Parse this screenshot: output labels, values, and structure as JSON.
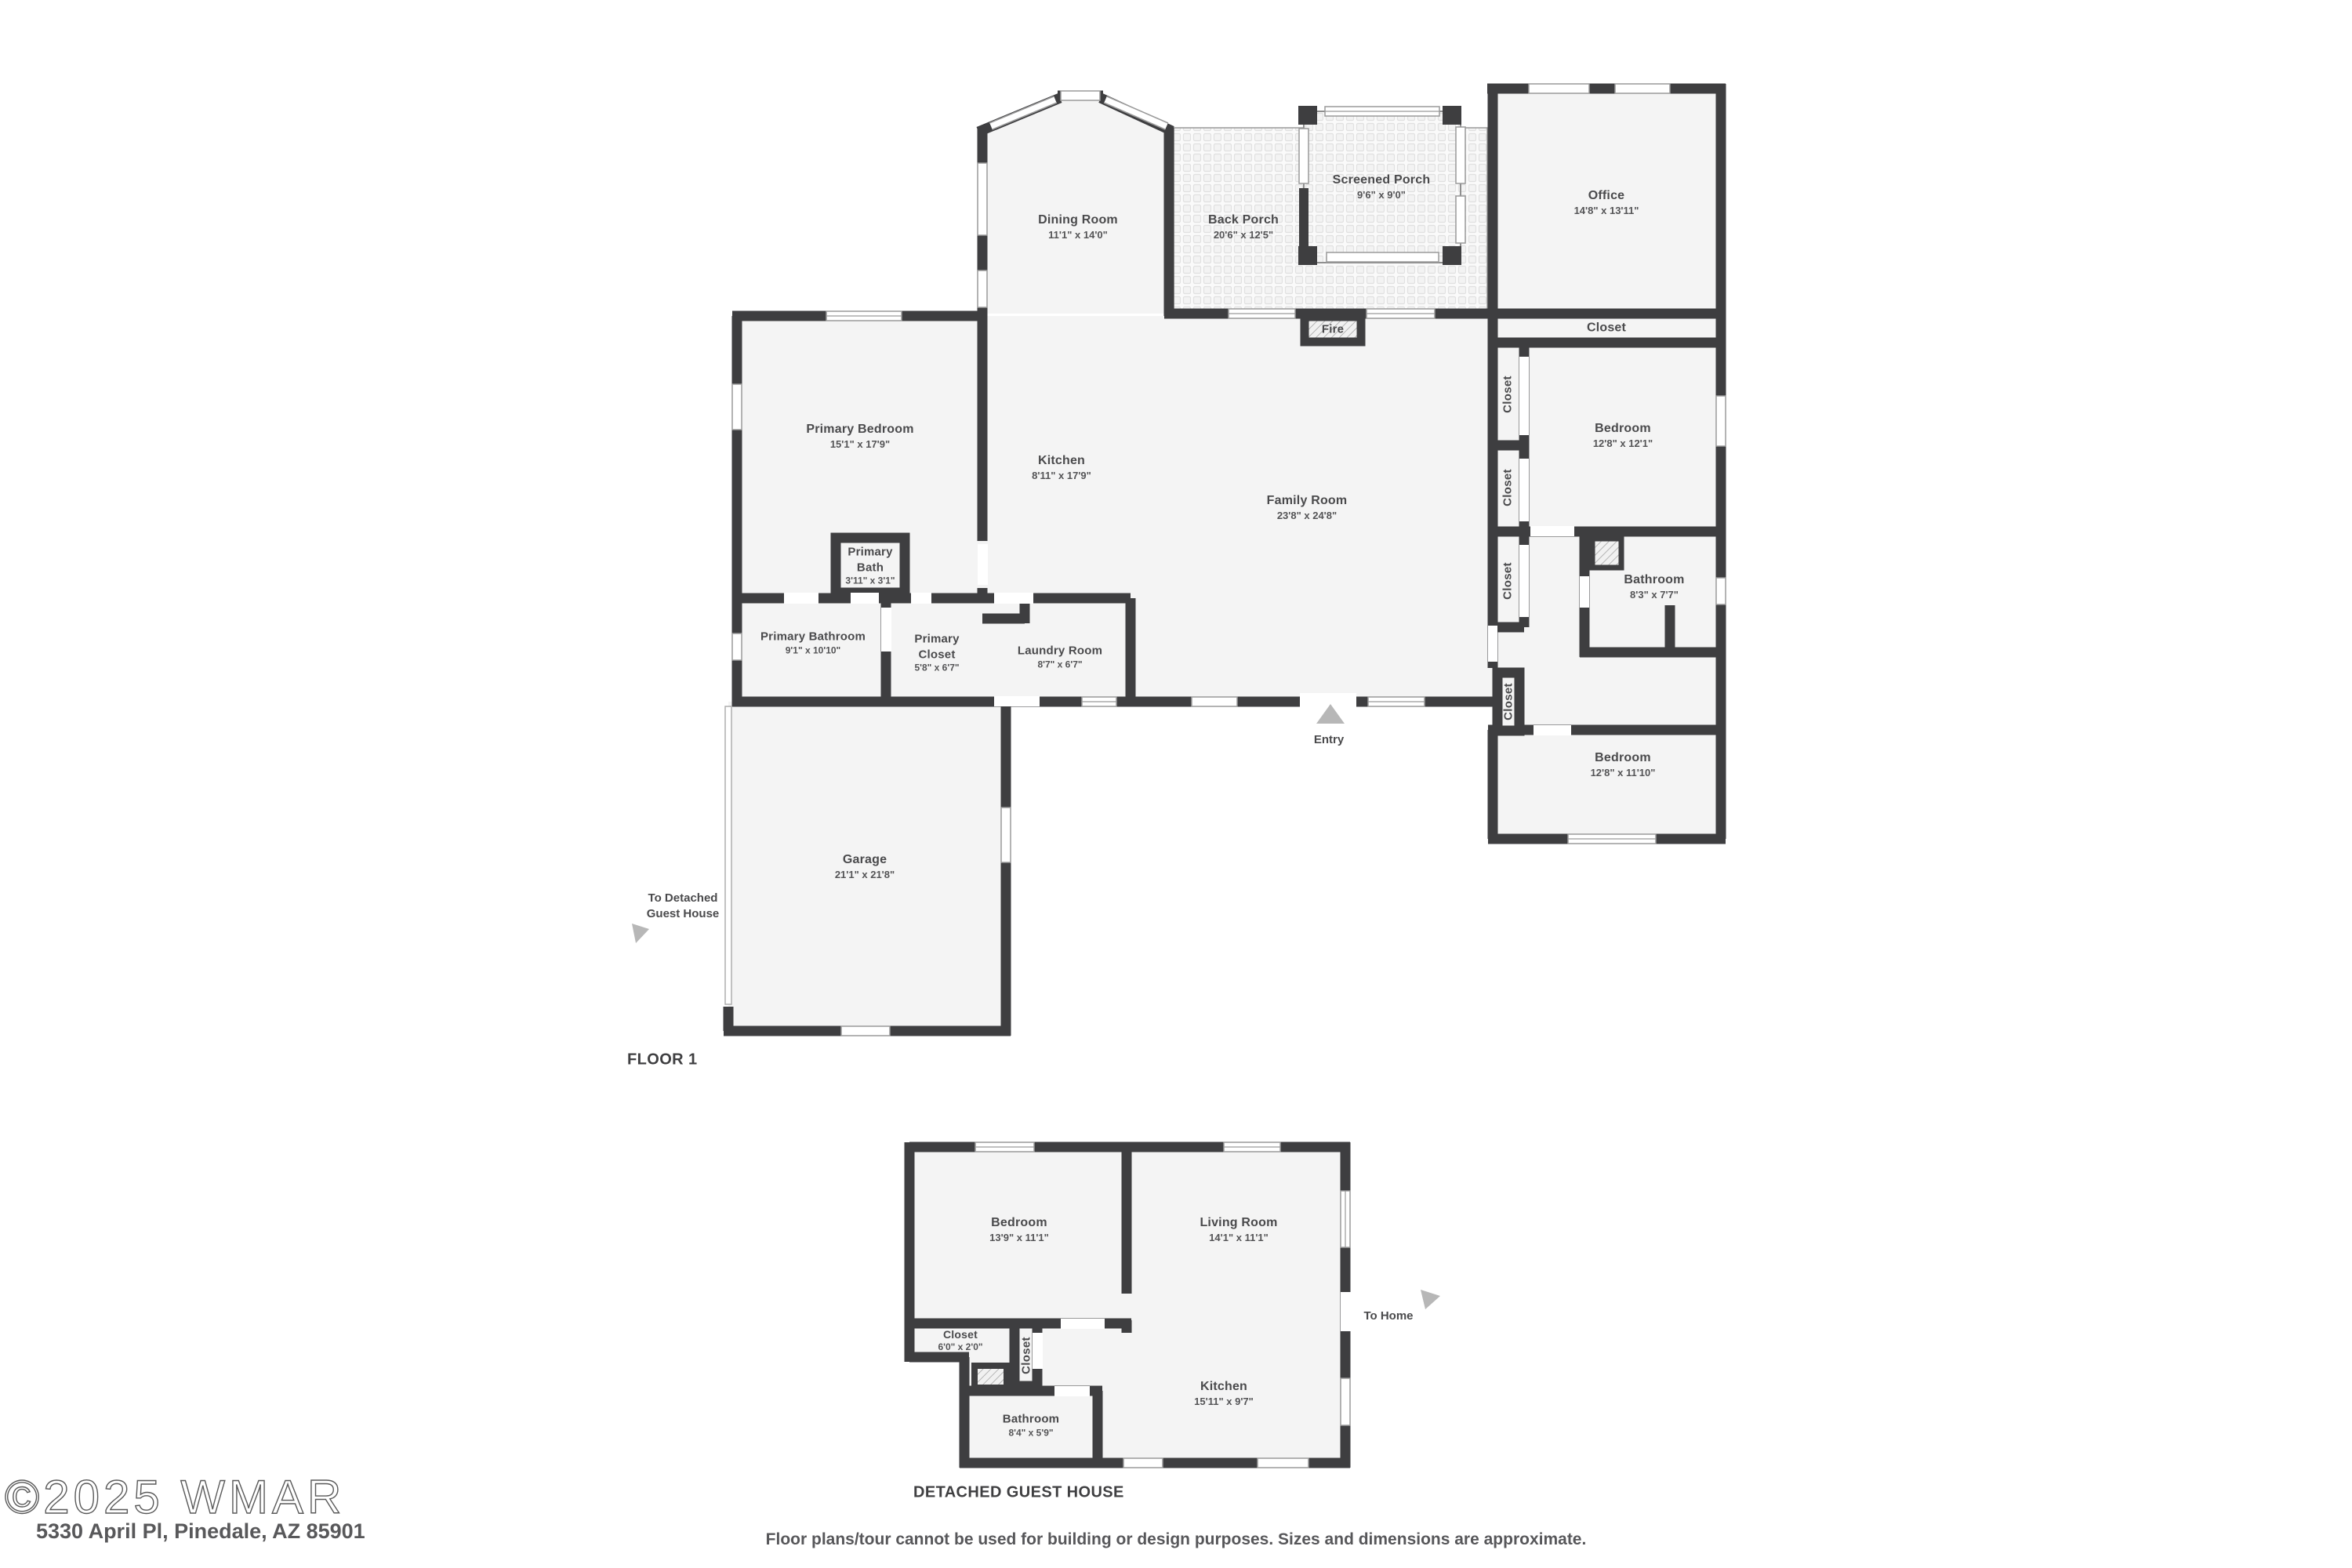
{
  "footer": {
    "watermark": "©2025 WMAR",
    "address": "5330 April Pl, Pinedale, AZ 85901",
    "disclaimer": "Floor plans/tour cannot be used for building or design purposes. Sizes and dimensions are approximate."
  },
  "floor1": {
    "label": "FLOOR 1",
    "entry_label": "Entry",
    "to_guest_label": "To Detached Guest House",
    "rooms": {
      "dining": {
        "name": "Dining Room",
        "dims": "11'1\" x 14'0\""
      },
      "backPorch": {
        "name": "Back Porch",
        "dims": "20'6\" x 12'5\""
      },
      "screenedPorch": {
        "name": "Screened Porch",
        "dims": "9'6\" x 9'0\""
      },
      "office": {
        "name": "Office",
        "dims": "14'8\" x 13'11\""
      },
      "officeCloset": {
        "name": "Closet"
      },
      "primaryBedroom": {
        "name": "Primary Bedroom",
        "dims": "15'1\" x 17'9\""
      },
      "kitchen": {
        "name": "Kitchen",
        "dims": "8'11\" x 17'9\""
      },
      "familyRoom": {
        "name": "Family Room",
        "dims": "23'8\" x 24'8\""
      },
      "fire": {
        "name": "Fire"
      },
      "bedroomTop": {
        "name": "Bedroom",
        "dims": "12'8\" x 12'1\""
      },
      "bathroom": {
        "name": "Bathroom",
        "dims": "8'3\" x 7'7\""
      },
      "bedroomBottom": {
        "name": "Bedroom",
        "dims": "12'8\" x 11'10\""
      },
      "primaryBath": {
        "name": "Primary Bath",
        "dims": "3'11\" x 3'1\""
      },
      "primaryBathroom": {
        "name": "Primary Bathroom",
        "dims": "9'1\" x 10'10\""
      },
      "primaryCloset": {
        "name": "Primary Closet",
        "dims": "5'8\" x 6'7\""
      },
      "laundry": {
        "name": "Laundry Room",
        "dims": "8'7\" x 6'7\""
      },
      "garage": {
        "name": "Garage",
        "dims": "21'1\" x 21'8\""
      },
      "closet1": {
        "name": "Closet"
      },
      "closet2": {
        "name": "Closet"
      },
      "closet3": {
        "name": "Closet"
      },
      "closet4": {
        "name": "Closet"
      }
    }
  },
  "guestHouse": {
    "label": "DETACHED GUEST HOUSE",
    "to_home_label": "To Home",
    "rooms": {
      "bedroom": {
        "name": "Bedroom",
        "dims": "13'9\" x 11'1\""
      },
      "livingRoom": {
        "name": "Living Room",
        "dims": "14'1\" x 11'1\""
      },
      "closet": {
        "name": "Closet",
        "dims": "6'0\" x 2'0\""
      },
      "closetSmall": {
        "name": "Closet"
      },
      "bathroom": {
        "name": "Bathroom",
        "dims": "8'4\" x 5'9\""
      },
      "kitchen": {
        "name": "Kitchen",
        "dims": "15'11\" x 9'7\""
      }
    }
  }
}
